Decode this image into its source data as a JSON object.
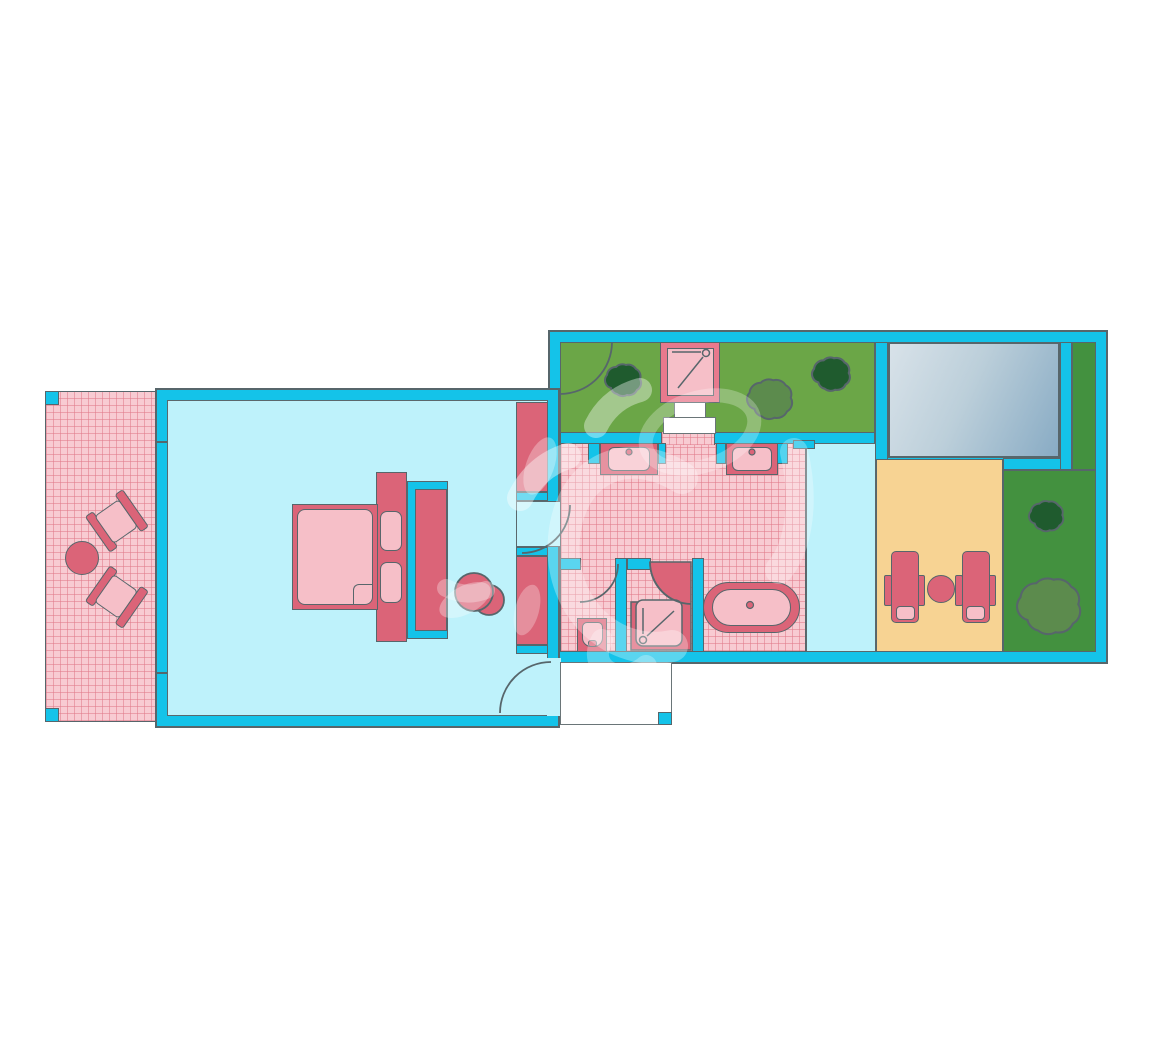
{
  "diagram": {
    "type": "floor-plan",
    "rooms": [
      {
        "name": "terrace"
      },
      {
        "name": "bedroom"
      },
      {
        "name": "bathroom"
      },
      {
        "name": "wc"
      },
      {
        "name": "shower-room"
      },
      {
        "name": "corridor"
      },
      {
        "name": "outdoor-shower-garden"
      },
      {
        "name": "pool"
      },
      {
        "name": "sun-deck"
      },
      {
        "name": "lawn"
      },
      {
        "name": "entrance-porch"
      }
    ],
    "furniture_icons": [
      "terrace-table-icon",
      "terrace-chair-icon",
      "double-bed-icon",
      "pillow-icon",
      "headboard-icon",
      "wardrobe-icon",
      "stool-icon",
      "closet-icon",
      "vanity-sink-icon",
      "bathtub-icon",
      "toilet-icon",
      "shower-tray-icon",
      "outdoor-shower-icon",
      "steps-icon",
      "sun-lounger-icon",
      "deck-table-icon",
      "bush-icon",
      "door-swing-arc-icon",
      "window-tick-icon"
    ],
    "palette": {
      "wall": "#14C3E9",
      "outline": "#57666B",
      "indoor_floor": "#BEF2FB",
      "tile_floor": "#F8CBD2",
      "tile_line": "#E07A8A",
      "furniture_dark": "#DB6478",
      "furniture_light": "#F6BFC8",
      "shower_frame": "#E8798D",
      "garden_light": "#6BA647",
      "garden_dark": "#43913F",
      "bush_dark": "#1F5B2E",
      "bush_medium": "#5C8B4D",
      "deck": "#F7D393",
      "pool_light": "#D8E2E9",
      "pool_dark": "#88ABC4",
      "porch": "#FFFFFF",
      "watermark": "rgba(255,255,255,0.35)"
    }
  }
}
